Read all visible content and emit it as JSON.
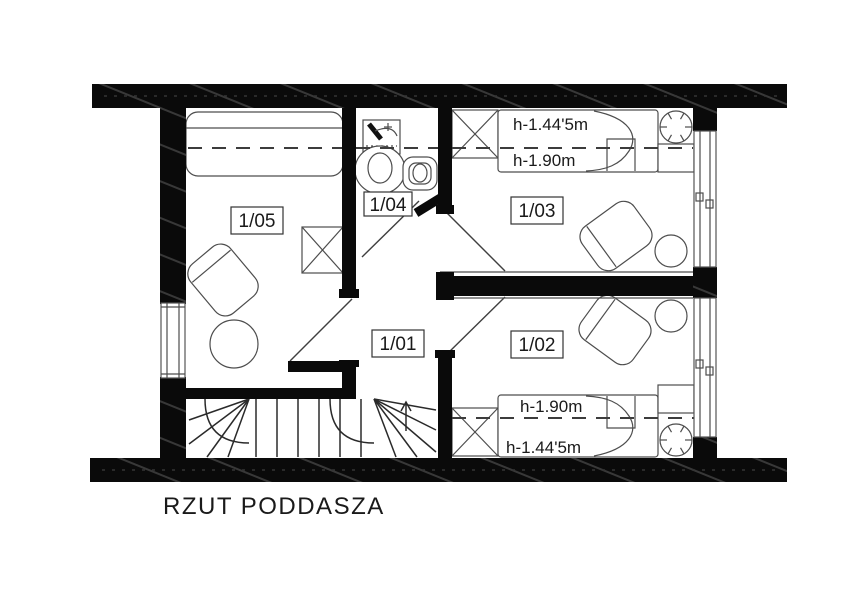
{
  "drawing": {
    "title": "RZUT PODDASZA",
    "rooms": [
      {
        "label": "1/05"
      },
      {
        "label": "1/04"
      },
      {
        "label": "1/03"
      },
      {
        "label": "1/01"
      },
      {
        "label": "1/02"
      }
    ],
    "height_annotations": {
      "room_1_03": {
        "line1": "h-1.44'5m",
        "line2": "h-1.90m"
      },
      "room_1_02": {
        "line1": "h-1.90m",
        "line2": "h-1.44'5m"
      }
    },
    "colors": {
      "walls": "#0a0a0a",
      "thin_lines": "#4d4d4d",
      "text": "#1a1a1a",
      "background": "#ffffff"
    }
  }
}
